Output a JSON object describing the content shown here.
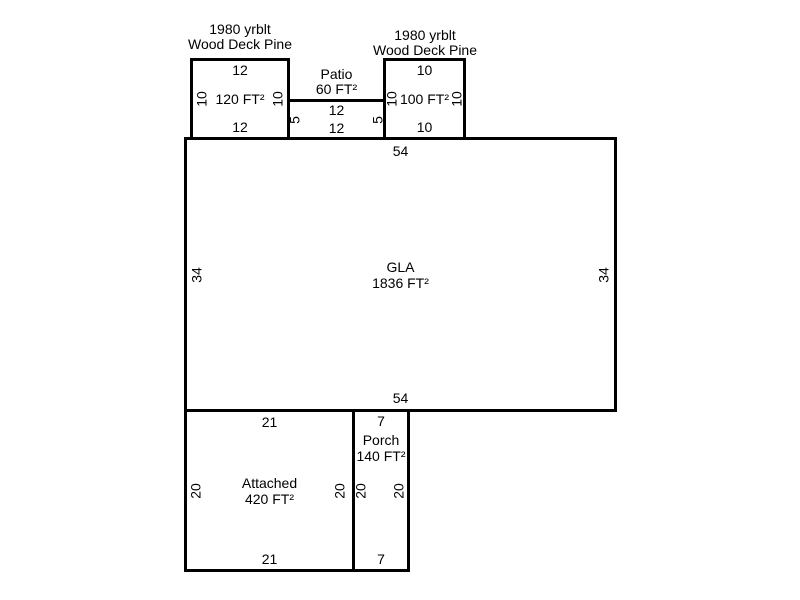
{
  "colors": {
    "background": "#ffffff",
    "line": "#000000",
    "text": "#000000"
  },
  "regions": {
    "deck_left": {
      "caption_line1": "1980 yrblt",
      "caption_line2": "Wood Deck Pine",
      "area": "120 FT²",
      "dim_top": "12",
      "dim_bottom": "12",
      "dim_left": "10",
      "dim_right": "10"
    },
    "patio": {
      "caption_line1": "Patio",
      "caption_line2": "60 FT²",
      "dim_top": "12",
      "dim_bottom": "12",
      "dim_left": "5",
      "dim_right": "5"
    },
    "deck_right": {
      "caption_line1": "1980 yrblt",
      "caption_line2": "Wood Deck Pine",
      "area": "100 FT²",
      "dim_top": "10",
      "dim_bottom": "10",
      "dim_left": "10",
      "dim_right": "10"
    },
    "gla": {
      "name": "GLA",
      "area": "1836 FT²",
      "dim_top": "54",
      "dim_bottom": "54",
      "dim_left": "34",
      "dim_right": "34"
    },
    "attached": {
      "name": "Attached",
      "area": "420 FT²",
      "dim_top": "21",
      "dim_bottom": "21",
      "dim_left": "20",
      "dim_right": "20"
    },
    "porch": {
      "name": "Porch",
      "area": "140 FT²",
      "dim_top": "7",
      "dim_bottom": "7",
      "dim_left": "20",
      "dim_right": "20"
    }
  }
}
